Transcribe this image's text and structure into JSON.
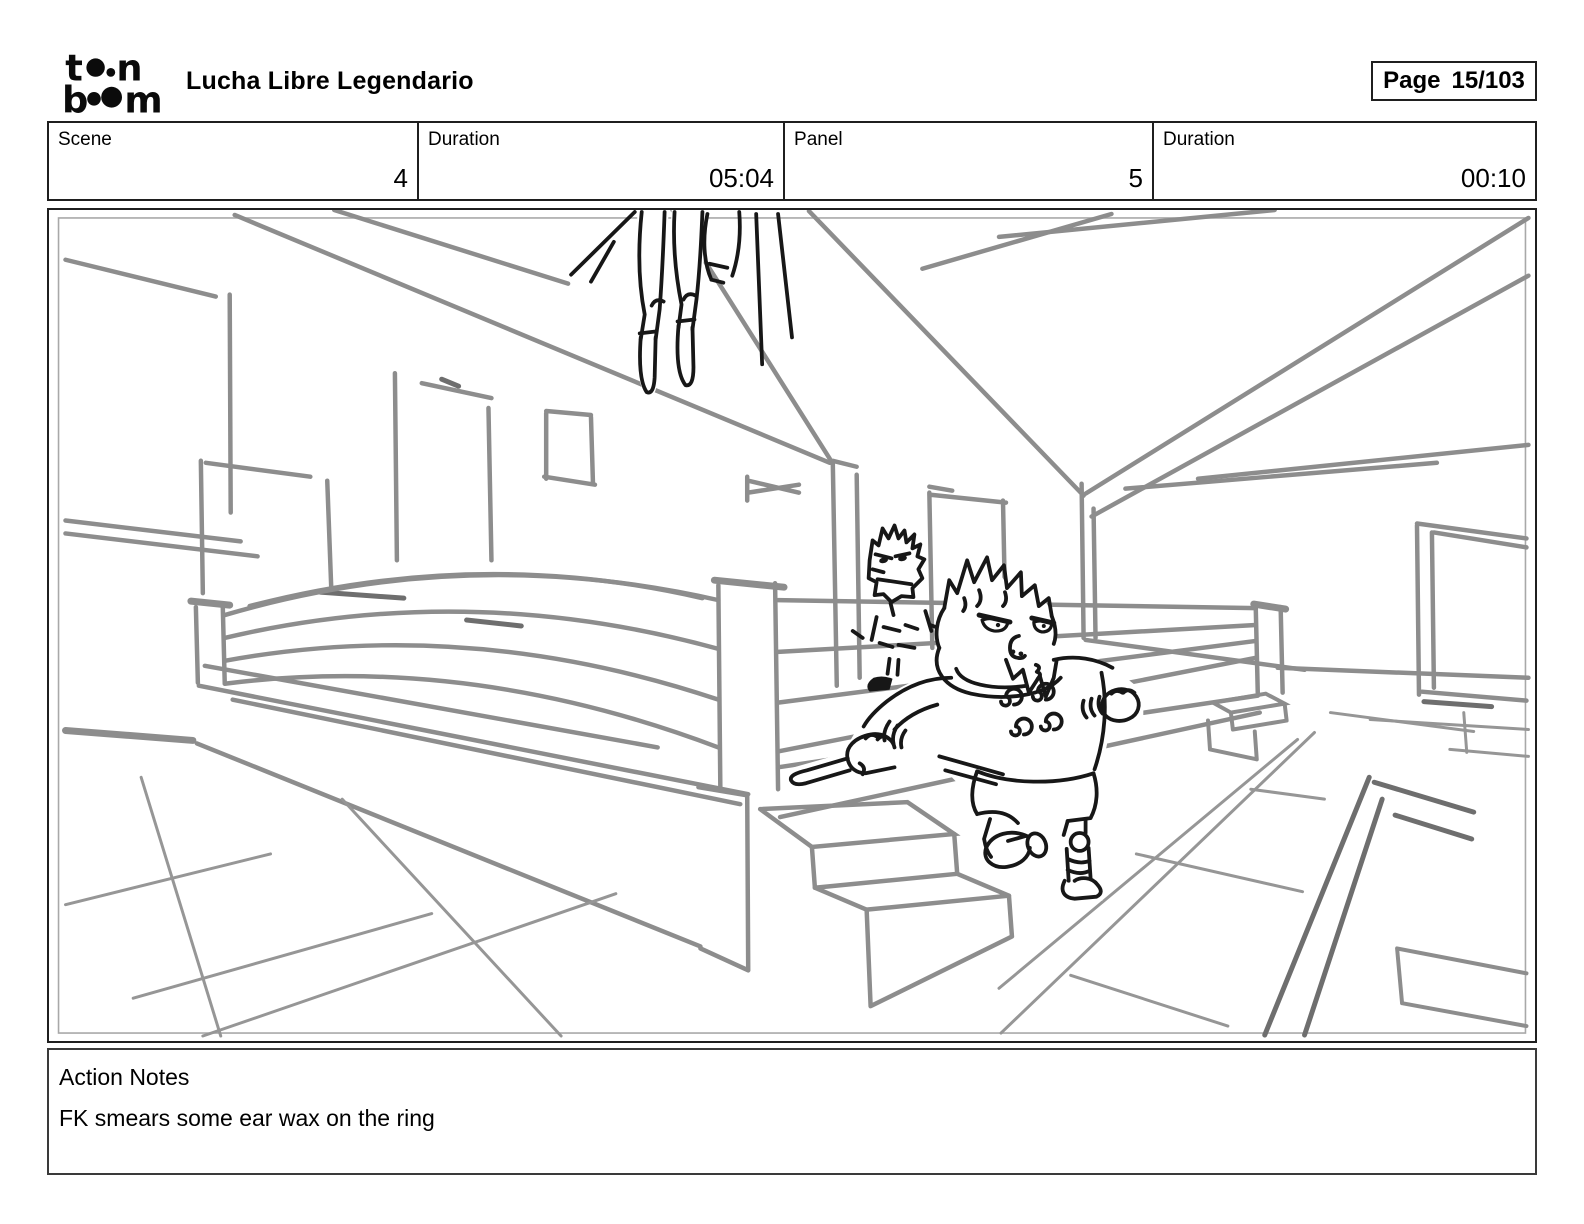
{
  "header": {
    "logo": {
      "name": "toon-boom-logo",
      "row1_first": "t",
      "row1_last": "n",
      "row2_first": "b",
      "row2_last": "m"
    },
    "title": "Lucha Libre Legendario",
    "page_label": "Page",
    "page_value": "15/103"
  },
  "info_table": {
    "cells": [
      {
        "label": "Scene",
        "value": "4"
      },
      {
        "label": "Duration",
        "value": "05:04"
      },
      {
        "label": "Panel",
        "value": "5"
      },
      {
        "label": "Duration",
        "value": "00:10"
      }
    ]
  },
  "panel": {
    "colors": {
      "sketch_gray": "#8d8d8d",
      "floor_gray": "#969696",
      "sketch_dark": "#6e6e6e",
      "ink_black": "#171717",
      "frame_black": "#1f1f1f",
      "inner_border": "#a8a8a8"
    }
  },
  "notes": {
    "heading": "Action Notes",
    "body": "FK smears some ear wax on the ring"
  }
}
